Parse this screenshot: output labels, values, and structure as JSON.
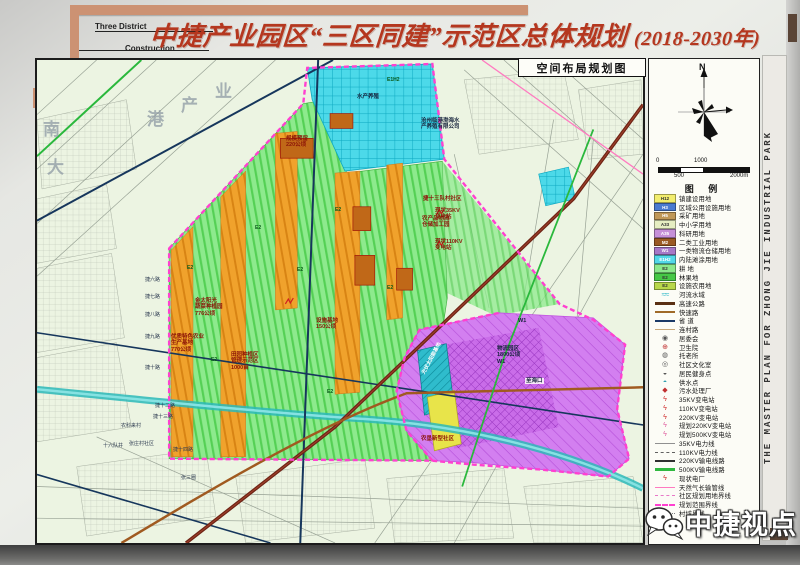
{
  "header": {
    "corner_label_1": "Three District",
    "corner_label_2": "Construction",
    "title": "中捷产业园区“三区同建”示范区总体规划",
    "title_suffix": "(2018-2030年)"
  },
  "side": {
    "vertical_text": "THE MASTER PLAN FOR ZHONG JIE INDUSTRIAL PARK"
  },
  "map": {
    "panel_title": "空间布局规划图",
    "labels": [
      {
        "t": "南",
        "x": 8,
        "y": 62,
        "cls": "big"
      },
      {
        "t": "大",
        "x": 12,
        "y": 100,
        "cls": "big"
      },
      {
        "t": "港",
        "x": 112,
        "y": 52,
        "cls": "big"
      },
      {
        "t": "产",
        "x": 146,
        "y": 38,
        "cls": "big"
      },
      {
        "t": "业",
        "x": 180,
        "y": 24,
        "cls": "big"
      },
      {
        "t": "水产养殖",
        "x": 322,
        "y": 36,
        "cls": "s"
      },
      {
        "t": "E1H2",
        "x": 352,
        "y": 20,
        "cls": "code"
      },
      {
        "t": "沧州临港渤海水\n产养殖有限公司",
        "x": 386,
        "y": 60,
        "cls": "s"
      },
      {
        "t": "规模预留\n220公顷",
        "x": 251,
        "y": 78,
        "cls": "red"
      },
      {
        "t": "农产品物流\n仓储加工园",
        "x": 387,
        "y": 158,
        "cls": "red"
      },
      {
        "t": "捷十三队村社区",
        "x": 388,
        "y": 138,
        "cls": "red"
      },
      {
        "t": "现状35KV\n变电站",
        "x": 400,
        "y": 150,
        "cls": "red"
      },
      {
        "t": "现状110KV\n变电站",
        "x": 400,
        "y": 181,
        "cls": "red"
      },
      {
        "t": "金太阳光\n蔬菜种植园\n776公顷",
        "x": 160,
        "y": 240,
        "cls": "red"
      },
      {
        "t": "优质特色农业\n生产基地\n770公顷",
        "x": 136,
        "y": 276,
        "cls": "red"
      },
      {
        "t": "田园种植区\n管理示范区\n1000亩",
        "x": 196,
        "y": 294,
        "cls": "red"
      },
      {
        "t": "设施基地\n150公顷",
        "x": 281,
        "y": 260,
        "cls": "red"
      },
      {
        "t": "W1",
        "x": 483,
        "y": 260,
        "cls": "s"
      },
      {
        "t": "物流园区\n1800公顷\nW1",
        "x": 462,
        "y": 288,
        "cls": "s"
      },
      {
        "t": "至海口",
        "x": 490,
        "y": 320,
        "cls": "s tag"
      },
      {
        "t": "光伏太阳能基地",
        "x": 380,
        "y": 298,
        "cls": "w",
        "rot": -62
      },
      {
        "t": "农垦新型社区",
        "x": 386,
        "y": 378,
        "cls": "red"
      },
      {
        "t": "捷六路",
        "x": 110,
        "y": 220,
        "cls": "rd"
      },
      {
        "t": "捷七路",
        "x": 110,
        "y": 237,
        "cls": "rd"
      },
      {
        "t": "捷八路",
        "x": 110,
        "y": 255,
        "cls": "rd"
      },
      {
        "t": "捷九路",
        "x": 110,
        "y": 277,
        "cls": "rd"
      },
      {
        "t": "捷十路",
        "x": 110,
        "y": 308,
        "cls": "rd"
      },
      {
        "t": "捷十二路",
        "x": 120,
        "y": 346,
        "cls": "rd"
      },
      {
        "t": "捷十三路",
        "x": 118,
        "y": 357,
        "cls": "rd"
      },
      {
        "t": "张庄村社区",
        "x": 94,
        "y": 384,
        "cls": "rd"
      },
      {
        "t": "捷十四路",
        "x": 138,
        "y": 390,
        "cls": "rd"
      },
      {
        "t": "农科来村",
        "x": 86,
        "y": 366,
        "cls": "rd"
      },
      {
        "t": "十六队井",
        "x": 68,
        "y": 386,
        "cls": "rd"
      },
      {
        "t": "张三圈",
        "x": 146,
        "y": 418,
        "cls": "rd"
      },
      {
        "t": "E2",
        "x": 152,
        "y": 208,
        "cls": "code"
      },
      {
        "t": "E2",
        "x": 220,
        "y": 168,
        "cls": "code"
      },
      {
        "t": "E2",
        "x": 176,
        "y": 300,
        "cls": "code"
      },
      {
        "t": "E2",
        "x": 262,
        "y": 210,
        "cls": "code"
      },
      {
        "t": "E2",
        "x": 292,
        "y": 332,
        "cls": "code"
      },
      {
        "t": "E2",
        "x": 352,
        "y": 228,
        "cls": "code"
      },
      {
        "t": "E2",
        "x": 300,
        "y": 150,
        "cls": "code"
      }
    ]
  },
  "compass": {
    "north_label": "N"
  },
  "scalebar": {
    "t0": "0",
    "t500": "500",
    "t1000": "1000",
    "t2000": "2000m"
  },
  "legend": {
    "title": "图  例",
    "items": [
      {
        "type": "area",
        "code": "H12",
        "color": "#f2ed6e",
        "dark": true,
        "label": "镇建设用地"
      },
      {
        "type": "area",
        "code": "H3",
        "color": "#4a7ad0",
        "dark": false,
        "label": "区域公用设施用地"
      },
      {
        "type": "area",
        "code": "H5",
        "color": "#c09858",
        "dark": false,
        "label": "采矿用地"
      },
      {
        "type": "area",
        "code": "A33",
        "color": "#e6eec2",
        "dark": true,
        "label": "中小学用地"
      },
      {
        "type": "area",
        "code": "A35",
        "color": "#c690d8",
        "dark": false,
        "label": "科研用地"
      },
      {
        "type": "area",
        "code": "M2",
        "color": "#9a5a24",
        "dark": false,
        "label": "二类工业用地"
      },
      {
        "type": "area",
        "code": "W1",
        "color": "#a678c8",
        "dark": false,
        "label": "一类物流仓储用地"
      },
      {
        "type": "area",
        "code": "E1H2",
        "color": "#52d8e8",
        "dark": false,
        "label": "内陆滩涂用地"
      },
      {
        "type": "area",
        "code": "E2",
        "color": "#8ce88c",
        "dark": true,
        "label": "耕  地"
      },
      {
        "type": "area",
        "code": "E2",
        "color": "#46c846",
        "dark": true,
        "label": "林果地"
      },
      {
        "type": "area",
        "code": "E2",
        "color": "#b8d84a",
        "dark": true,
        "label": "设施农用地"
      },
      {
        "type": "wave",
        "color": "#2cb8c8",
        "label": "河流水域"
      },
      {
        "type": "line",
        "color": "#5a3014",
        "w": 3,
        "dash": "solid",
        "label": "高速公路"
      },
      {
        "type": "line",
        "color": "#a06a28",
        "w": 2.5,
        "dash": "solid",
        "label": "快速路"
      },
      {
        "type": "line",
        "color": "#1a3a68",
        "w": 2,
        "dash": "solid",
        "label": "省  道"
      },
      {
        "type": "line",
        "color": "#c8a878",
        "w": 1.5,
        "dash": "solid",
        "label": "连村路"
      },
      {
        "type": "sym",
        "glyph": "◉",
        "color": "#555555",
        "label": "居委会"
      },
      {
        "type": "sym",
        "glyph": "⊕",
        "color": "#c03030",
        "label": "卫生院"
      },
      {
        "type": "sym",
        "glyph": "◍",
        "color": "#555555",
        "label": "托老所"
      },
      {
        "type": "sym",
        "glyph": "◎",
        "color": "#555555",
        "label": "社区文化室"
      },
      {
        "type": "sym",
        "glyph": "◒",
        "color": "#555555",
        "label": "居民健身点"
      },
      {
        "type": "sym",
        "glyph": "◓",
        "color": "#2f9fb0",
        "label": "供水点"
      },
      {
        "type": "sym",
        "glyph": "◆",
        "color": "#c03030",
        "label": "污水处理厂"
      },
      {
        "type": "sym",
        "glyph": "ϟ",
        "color": "#d03030",
        "label": "35KV变电站"
      },
      {
        "type": "sym",
        "glyph": "ϟ",
        "color": "#d03030",
        "label": "110KV变电站"
      },
      {
        "type": "sym",
        "glyph": "ϟ",
        "color": "#d03030",
        "label": "220KV变电站"
      },
      {
        "type": "sym",
        "glyph": "ϟ",
        "color": "#e060a0",
        "label": "规划220KV变电站"
      },
      {
        "type": "sym",
        "glyph": "ϟ",
        "color": "#e060a0",
        "label": "规划500KV变电站"
      },
      {
        "type": "line",
        "color": "#909090",
        "w": 1,
        "dash": "solid",
        "label": "35KV电力线"
      },
      {
        "type": "line",
        "color": "#606060",
        "w": 1,
        "dash": "dashed",
        "label": "110KV电力线"
      },
      {
        "type": "line",
        "color": "#303030",
        "w": 2,
        "dash": "solid",
        "label": "220KV输电线路"
      },
      {
        "type": "line",
        "color": "#30b840",
        "w": 3,
        "dash": "solid",
        "label": "500KV输电线路"
      },
      {
        "type": "sym",
        "glyph": "ϟ",
        "color": "#d03030",
        "label": "现状电厂"
      },
      {
        "type": "line",
        "color": "#ff7ac0",
        "w": 1.5,
        "dash": "solid",
        "label": "天然气长输管线"
      },
      {
        "type": "line",
        "color": "#e878c8",
        "w": 1.5,
        "dash": "dashed",
        "label": "社区规划用地界线"
      },
      {
        "type": "line",
        "color": "#ff40d0",
        "w": 2.5,
        "dash": "dashed",
        "label": "规划范围界线"
      },
      {
        "type": "line",
        "color": "#808080",
        "w": 1,
        "dash": "dotted",
        "label": "村域界线"
      }
    ]
  },
  "watermark": {
    "text": "中捷视点"
  },
  "colors": {
    "title_red": "#b5371f",
    "frame_tan": "#cc9273",
    "boundary_magenta": "#ff40d0"
  }
}
